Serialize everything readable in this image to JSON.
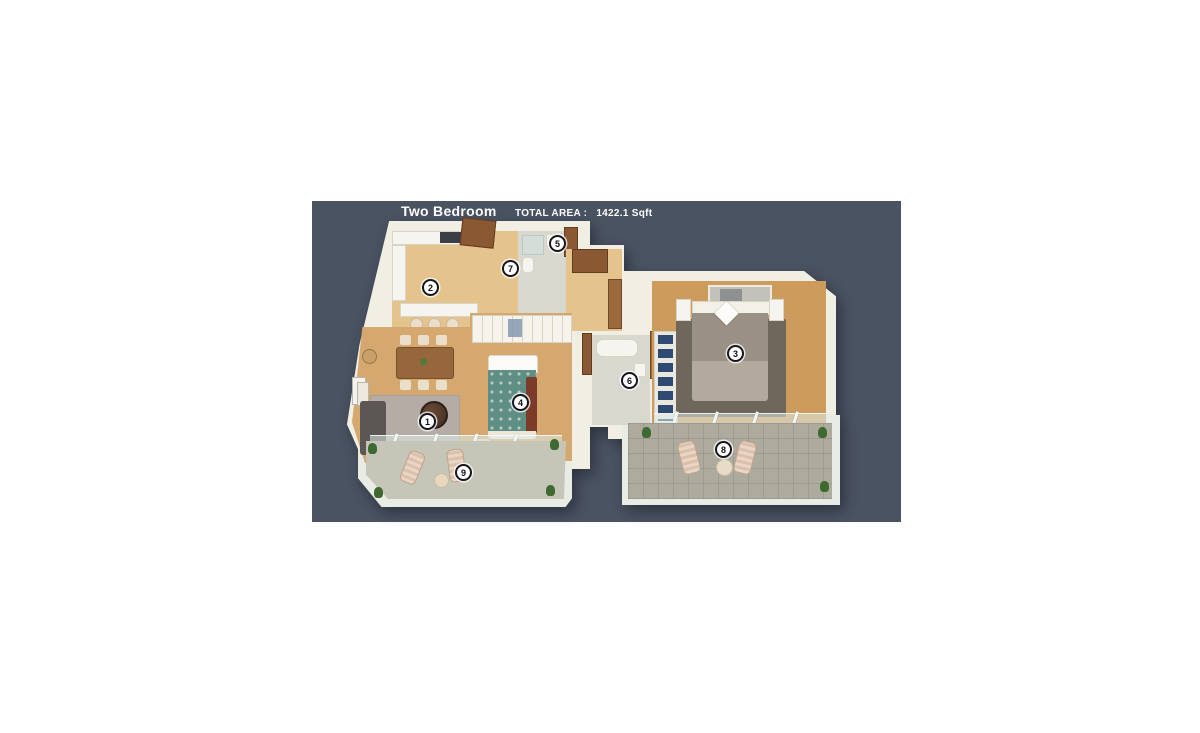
{
  "header": {
    "title": "Two Bedroom",
    "total_area_label": "TOTAL AREA :",
    "total_area_value": "1422.1 Sqft"
  },
  "markers": [
    {
      "label": "1"
    },
    {
      "label": "2"
    },
    {
      "label": "3"
    },
    {
      "label": "4"
    },
    {
      "label": "5"
    },
    {
      "label": "6"
    },
    {
      "label": "7"
    },
    {
      "label": "8"
    },
    {
      "label": "9"
    }
  ],
  "colors": {
    "page_bg": "#ffffff",
    "panel_bg": "#4a5362",
    "header_text": "#ffffff",
    "wall": "#f1eee4",
    "wood_floor": "#d5a870",
    "wood_floor_pale": "#e4c48c",
    "wood_floor_master": "#cd9c5c",
    "tile_floor": "#d9d8ce",
    "rug": "#b5ada5",
    "rug_master": "#6f665c",
    "balcony_left_floor": "#c6c6b8",
    "balcony_right_floor": "#adab9e",
    "marker_bg": "#ffffff",
    "marker_ring": "#16161d",
    "marker_text": "#101014",
    "bed_teal": "#5f8e85",
    "bed_maroon": "#7c3a29",
    "bed_taupe": "#9a9084",
    "door_brown": "#8a5832",
    "sofa_gray": "#5c5754",
    "closet_blue": "#2e4a73",
    "plant_green": "#3e6a32",
    "lounger": "#dcc0aa"
  }
}
